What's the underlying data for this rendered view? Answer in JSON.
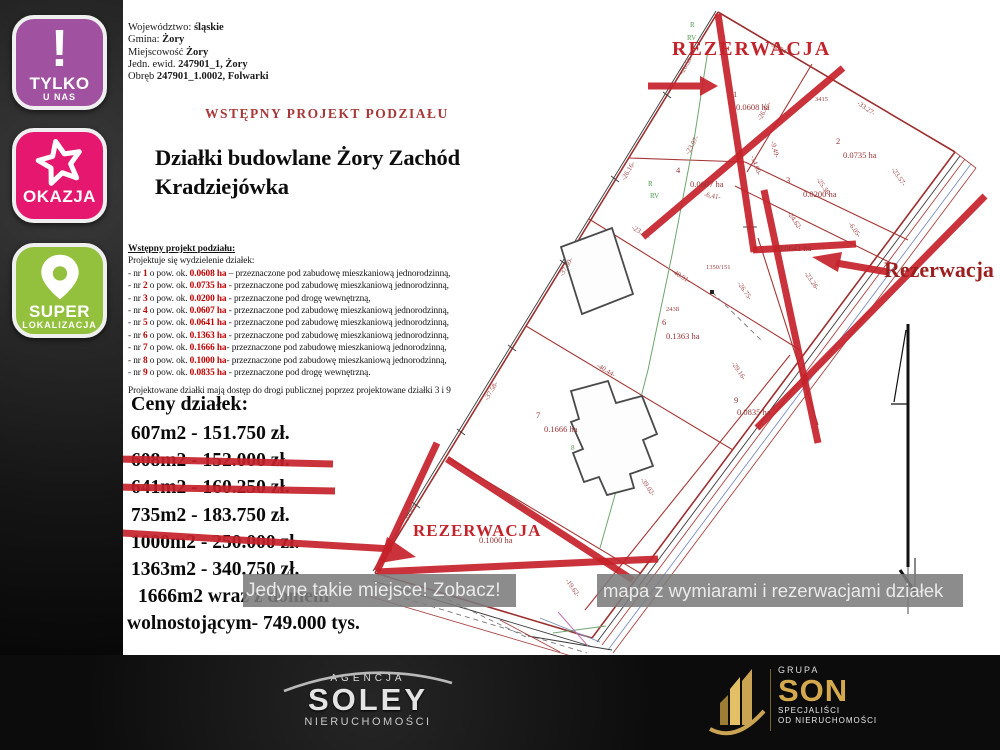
{
  "badges": [
    {
      "id": "tylko-u-nas",
      "icon": "exclamation",
      "line1": "TYLKO",
      "line2": "U NAS",
      "color": "#a0519f"
    },
    {
      "id": "okazja",
      "icon": "star",
      "line1": "OKAZJA",
      "line2": "",
      "color": "#e6176e"
    },
    {
      "id": "super-lokalizacja",
      "icon": "pin",
      "line1": "SUPER",
      "line2": "LOKALIZACJA",
      "color": "#94c13d"
    }
  ],
  "header": {
    "lines": [
      {
        "label": "Województwo: ",
        "value": "śląskie"
      },
      {
        "label": "Gmina: ",
        "value": "Żory"
      },
      {
        "label": "Miejscowość ",
        "value": "Żory"
      },
      {
        "label": "Jedn. ewid. ",
        "value": "247901_1, Żory"
      },
      {
        "label": "Obręb ",
        "value": "247901_1.0002, Folwarki"
      }
    ],
    "project_title": "WSTĘPNY PROJEKT PODZIAŁU",
    "main_title_line1": "Działki budowlane Żory Zachód",
    "main_title_line2": "Kradziejówka"
  },
  "subdivision": {
    "heading": "Wstępny projekt podziału:",
    "intro": "Projektuje się wydzielenie działek:",
    "plots": [
      {
        "nr": "1",
        "area": "0.0608 ha",
        "sep": " – ",
        "purpose": "przeznaczone pod zabudowę mieszkaniową jednorodzinną,"
      },
      {
        "nr": "2",
        "area": "0.0735 ha",
        "sep": " - ",
        "purpose": "przeznaczone pod zabudowę mieszkaniową jednorodzinną,"
      },
      {
        "nr": "3",
        "area": "0.0200 ha",
        "sep": " - ",
        "purpose": "przeznaczone pod drogę wewnętrzną,"
      },
      {
        "nr": "4",
        "area": "0.0607 ha",
        "sep": " - ",
        "purpose": "przeznaczone pod zabudowę mieszkaniową jednorodzinną,"
      },
      {
        "nr": "5",
        "area": "0.0641 ha",
        "sep": " - ",
        "purpose": "przeznaczone pod zabudowę mieszkaniową jednorodzinną,"
      },
      {
        "nr": "6",
        "area": "0.1363 ha",
        "sep": " - ",
        "purpose": "przeznaczone pod zabudowę mieszkaniową jednorodzinną,"
      },
      {
        "nr": "7",
        "area": "0.1666 ha",
        "sep": "- ",
        "purpose": "przeznaczone pod zabudowę mieszkaniową jednorodzinną,"
      },
      {
        "nr": "8",
        "area": "0.1000 ha",
        "sep": "- ",
        "purpose": "przeznaczone pod zabudowę mieszkaniową jednorodzinną,"
      },
      {
        "nr": "9",
        "area": "0.0835 ha",
        "sep": " - ",
        "purpose": "przeznaczone pod drogę wewnętrzną."
      }
    ],
    "note": "Projektowane działki mają dostęp do drogi publicznej poprzez projektowane działki 3 i 9"
  },
  "prices": {
    "heading": "Ceny działek:",
    "items": [
      {
        "text": "607m2 - 151.750 zł.",
        "strike": false
      },
      {
        "text": "608m2 - 152.000 zł.",
        "strike": true
      },
      {
        "text": "641m2 - 160.250 zł.",
        "strike": true
      },
      {
        "text": "735m2 - 183.750 zł.",
        "strike": false
      },
      {
        "text": "1000m2 - 250.000 zł.",
        "strike": true
      },
      {
        "text": "1363m2 - 340.750 zł.",
        "strike": false
      },
      {
        "text": "1666m2 wraz z domem",
        "strike": false
      },
      {
        "text": "wolnostojącym- 749.000 tys.",
        "strike": false
      }
    ],
    "strike_color": "#c5222a"
  },
  "banner": {
    "left_text": "Jedyne takie miejsce! Zobacz!",
    "right_text": "mapa z wymiarami i rezerwacjami działek"
  },
  "map": {
    "lines": [
      [
        718,
        12,
        955,
        152,
        "b"
      ],
      [
        955,
        152,
        592,
        638,
        "b"
      ],
      [
        375,
        573,
        592,
        638,
        "b"
      ],
      [
        718,
        12,
        375,
        573,
        "b"
      ],
      [
        960,
        156,
        597,
        642,
        "sv"
      ],
      [
        965,
        159,
        602,
        645,
        "rd"
      ],
      [
        971,
        164,
        608,
        650,
        "bl"
      ],
      [
        976,
        168,
        613,
        653,
        "rd"
      ],
      [
        955,
        152,
        976,
        168,
        "rd"
      ],
      [
        373,
        581,
        590,
        646,
        "sv"
      ],
      [
        368,
        596,
        585,
        660,
        "rd"
      ],
      [
        370,
        588,
        587,
        653,
        "dh"
      ],
      [
        716,
        11,
        373,
        571,
        "sv"
      ],
      [
        663,
        92,
        671,
        98,
        "sv"
      ],
      [
        611,
        176,
        619,
        182,
        "sv"
      ],
      [
        560,
        260,
        568,
        266,
        "sv"
      ],
      [
        508,
        345,
        516,
        351,
        "sv"
      ],
      [
        457,
        429,
        465,
        435,
        "sv"
      ],
      [
        412,
        502,
        420,
        508,
        "sv"
      ],
      [
        812,
        64,
        747,
        172,
        "s"
      ],
      [
        629,
        158,
        745,
        162,
        "s"
      ],
      [
        745,
        162,
        908,
        240,
        "s"
      ],
      [
        735,
        186,
        893,
        264,
        "s"
      ],
      [
        589,
        219,
        800,
        350,
        "s"
      ],
      [
        758,
        238,
        818,
        425,
        "s"
      ],
      [
        526,
        326,
        733,
        450,
        "s"
      ],
      [
        448,
        458,
        640,
        573,
        "s"
      ],
      [
        790,
        355,
        585,
        610,
        "s"
      ],
      [
        708,
        50,
        694,
        140,
        "gr"
      ],
      [
        694,
        140,
        672,
        255,
        "gr"
      ],
      [
        672,
        255,
        648,
        370,
        "gr"
      ],
      [
        648,
        370,
        622,
        470,
        "gr"
      ],
      [
        622,
        470,
        600,
        548,
        "gr"
      ],
      [
        712,
        292,
        762,
        341,
        "dh"
      ],
      [
        432,
        592,
        528,
        638,
        "dh"
      ],
      [
        528,
        636,
        612,
        650,
        "sv"
      ],
      [
        540,
        618,
        600,
        642,
        "bl"
      ],
      [
        553,
        633,
        606,
        626,
        "gr"
      ],
      [
        558,
        612,
        588,
        646,
        "mg"
      ],
      [
        500,
        620,
        560,
        652,
        "rd"
      ],
      [
        908,
        324,
        908,
        567,
        "na",
        3
      ],
      [
        906,
        330,
        894,
        402,
        "na",
        1.2
      ],
      [
        891,
        404,
        908,
        404,
        "na",
        1.2
      ],
      [
        900,
        570,
        915,
        592,
        "na",
        3
      ],
      [
        915,
        558,
        915,
        598,
        "na",
        1
      ],
      [
        908,
        567,
        908,
        614,
        "sv"
      ],
      [
        743,
        227,
        757,
        227,
        "sv"
      ],
      [
        750,
        220,
        750,
        234,
        "sv"
      ],
      [
        586,
        448,
        600,
        448,
        "sv"
      ],
      [
        593,
        441,
        593,
        455,
        "sv"
      ],
      [
        718,
        14,
        754,
        252,
        "x"
      ],
      [
        643,
        237,
        843,
        68,
        "x"
      ],
      [
        753,
        250,
        856,
        244,
        "x",
        5
      ],
      [
        764,
        190,
        818,
        443,
        "x"
      ],
      [
        757,
        428,
        985,
        196,
        "x"
      ],
      [
        447,
        459,
        633,
        580,
        "x"
      ],
      [
        377,
        572,
        658,
        559,
        "x"
      ],
      [
        437,
        443,
        377,
        571,
        "x",
        5
      ],
      [
        648,
        86,
        700,
        86,
        "x",
        6
      ],
      [
        888,
        272,
        836,
        263,
        "x",
        5
      ],
      [
        122,
        533,
        392,
        549,
        "x",
        6
      ],
      [
        119,
        459,
        333,
        464,
        "x",
        6
      ],
      [
        113,
        487,
        335,
        491,
        "x",
        6
      ]
    ],
    "polys": [
      {
        "pts": "561,247 612,228 633,294 582,314",
        "cls": "bld"
      },
      {
        "pts": "571,391 608,381 616,403 642,396 657,434 643,440 653,466 630,474 634,488 607,495 599,477 584,482 573,453 583,449 571,422 579,419",
        "cls": "bld"
      },
      {
        "pts": "710,290 714,290 714,294 710,294",
        "cls": "dot"
      },
      {
        "pts": "700,76 718,86 700,96",
        "cls": "xf"
      },
      {
        "pts": "812,257 842,252 838,272",
        "cls": "xf"
      },
      {
        "pts": "416,557 387,537 380,563",
        "cls": "xf"
      }
    ],
    "labels": [
      [
        "REZERWACJA",
        672,
        55,
        0,
        "res"
      ],
      [
        "REZERWACJA",
        413,
        536,
        0,
        "resb"
      ],
      [
        "Rezerwacja",
        884,
        277,
        0,
        "res2"
      ],
      [
        "-32.94-",
        778,
        50,
        30,
        "dim"
      ],
      [
        "-26.50-",
        688,
        66,
        -60,
        "dim"
      ],
      [
        "-26.45-",
        766,
        112,
        -60,
        "dim"
      ],
      [
        "-23.07-",
        694,
        146,
        -60,
        "dim"
      ],
      [
        "-26.16-",
        630,
        172,
        -60,
        "dim"
      ],
      [
        "-33.27-",
        865,
        110,
        35,
        "dim"
      ],
      [
        "-9,49-",
        773,
        150,
        75,
        "dim"
      ],
      [
        "-6,41-",
        712,
        198,
        10,
        "dim"
      ],
      [
        "-25.36-",
        822,
        188,
        55,
        "dim"
      ],
      [
        "-23.57-",
        897,
        178,
        55,
        "dim"
      ],
      [
        "-24.62-",
        793,
        222,
        55,
        "dim"
      ],
      [
        "-6.05-",
        853,
        231,
        55,
        "dim"
      ],
      [
        "-14.00-",
        754,
        166,
        70,
        "dim"
      ],
      [
        "-23.26-",
        810,
        282,
        55,
        "dim"
      ],
      [
        "-23.17-",
        640,
        234,
        30,
        "dim"
      ],
      [
        "-37.50-",
        568,
        268,
        -60,
        "dim"
      ],
      [
        "-26.75-",
        743,
        292,
        55,
        "dim"
      ],
      [
        "-48.91-",
        680,
        278,
        32,
        "dim"
      ],
      [
        "-40.44-",
        605,
        372,
        32,
        "dim"
      ],
      [
        "-29.16-",
        737,
        372,
        55,
        "dim"
      ],
      [
        "-37.58-",
        493,
        392,
        -60,
        "dim"
      ],
      [
        "-39.02-",
        646,
        488,
        55,
        "dim"
      ],
      [
        "-39.82-",
        412,
        514,
        -60,
        "dim"
      ],
      [
        "-41,90-",
        516,
        506,
        30,
        "dim"
      ],
      [
        "-19.62-",
        571,
        589,
        55,
        "dim"
      ],
      [
        "3415",
        815,
        101,
        0,
        "num"
      ],
      [
        "1350/151",
        706,
        269,
        0,
        "num"
      ],
      [
        "2438",
        666,
        311,
        0,
        "num"
      ],
      [
        "1",
        733,
        97,
        0,
        "ar"
      ],
      [
        "0.0608 ha",
        736,
        110,
        0,
        "ar"
      ],
      [
        "2",
        836,
        144,
        0,
        "ar"
      ],
      [
        "0.0735 ha",
        843,
        158,
        0,
        "ar"
      ],
      [
        "3",
        786,
        183,
        0,
        "ar"
      ],
      [
        "0.0200 ha",
        803,
        197,
        0,
        "ar"
      ],
      [
        "4",
        676,
        173,
        0,
        "ar"
      ],
      [
        "0.0607 ha",
        690,
        187,
        0,
        "ar"
      ],
      [
        "0.0641 ha",
        778,
        251,
        0,
        "ar"
      ],
      [
        "6",
        662,
        325,
        0,
        "ar"
      ],
      [
        "0.1363 ha",
        666,
        339,
        0,
        "ar"
      ],
      [
        "7",
        536,
        418,
        0,
        "ar"
      ],
      [
        "0.1666 ha",
        544,
        432,
        0,
        "ar"
      ],
      [
        "9",
        734,
        403,
        0,
        "ar"
      ],
      [
        "0.0835 ha",
        737,
        415,
        0,
        "ar"
      ],
      [
        "0.1000 ha",
        479,
        543,
        0,
        "ar"
      ],
      [
        "R",
        690,
        27,
        0,
        "grt"
      ],
      [
        "RV",
        687,
        40,
        0,
        "grt"
      ],
      [
        "R",
        648,
        186,
        0,
        "grt"
      ],
      [
        "RV",
        650,
        198,
        0,
        "grt"
      ],
      [
        "8",
        571,
        450,
        0,
        "grt"
      ]
    ]
  },
  "footer": {
    "soley": {
      "top": "AGENCJA",
      "name": "SOLEY",
      "bottom": "NIERUCHOMOŚCI"
    },
    "son": {
      "top": "GRUPA",
      "name": "SON",
      "sub1": "SPECJALIŚCI",
      "sub2": "OD NIERUCHOMOŚCI"
    }
  }
}
